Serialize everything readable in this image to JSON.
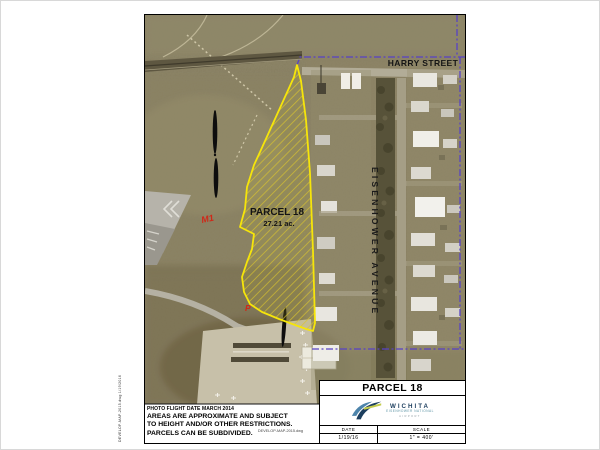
{
  "page": {
    "plot_stamp": "DEVELOP-MAP-2015.dwg  1/19/2016",
    "file_label": "DEVELOP-MAP-2015.dwg"
  },
  "map": {
    "street_label": "HARRY STREET",
    "avenue_label": "EISENHOWER AVENUE",
    "parcel_label": "PARCEL 18",
    "parcel_area": "27.21 ac.",
    "zone_m1": "M1",
    "zone_p": "P",
    "parcel_outline_color": "#f6e50a",
    "boundary_color": "#5742c6"
  },
  "disclaimer": {
    "photo_line": "PHOTO FLIGHT DATE MARCH 2014",
    "line1": "AREAS ARE APPROXIMATE AND SUBJECT",
    "line2": "TO HEIGHT AND/OR OTHER RESTRICTIONS.",
    "line3": "PARCELS CAN BE SUBDIVIDED."
  },
  "title_block": {
    "title": "PARCEL 18",
    "logo_name": "WICHITA",
    "logo_sub1": "EISENHOWER NATIONAL",
    "logo_sub2": "AIRPORT",
    "date_label": "DATE",
    "scale_label": "SCALE",
    "date_value": "1/19/16",
    "scale_value": "1\" = 400'"
  }
}
